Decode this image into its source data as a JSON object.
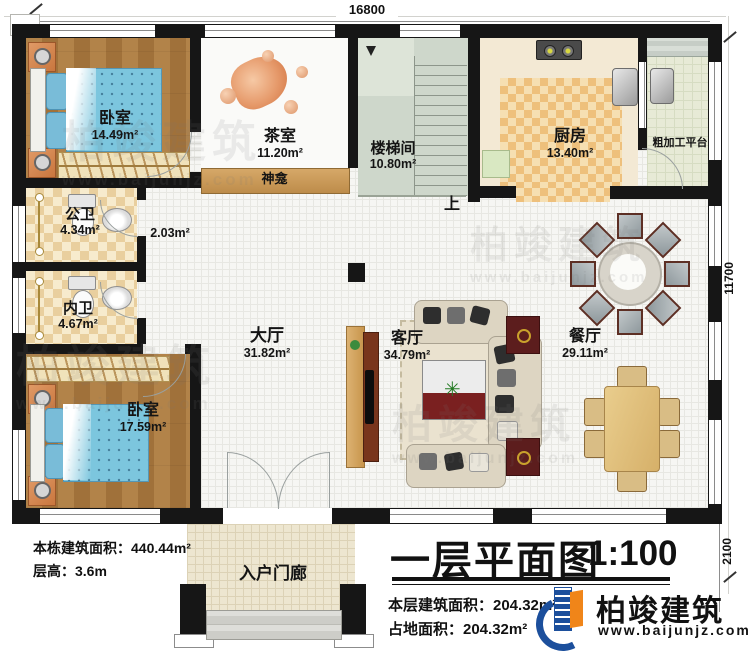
{
  "dimensions": {
    "width_total": "16800",
    "depth_total": "11700",
    "porch_depth": "2100"
  },
  "rooms": {
    "bedroom1": {
      "name": "卧室",
      "area": "14.49m²"
    },
    "tea_room": {
      "name": "茶室",
      "area": "11.20m²"
    },
    "stairwell": {
      "name": "楼梯间",
      "area": "10.80m²"
    },
    "kitchen": {
      "name": "厨房",
      "area": "13.40m²"
    },
    "prep_platform": {
      "name": "粗加工平台"
    },
    "shrine": {
      "name": "神龛"
    },
    "public_bath": {
      "name": "公卫",
      "area": "4.34m²"
    },
    "corridor": {
      "area": "2.03m²"
    },
    "inner_bath": {
      "name": "内卫",
      "area": "4.67m²"
    },
    "bedroom2": {
      "name": "卧室",
      "area": "17.59m²"
    },
    "hall": {
      "name": "大厅",
      "area": "31.82m²"
    },
    "living_room": {
      "name": "客厅",
      "area": "34.79m²"
    },
    "dining_room": {
      "name": "餐厅",
      "area": "29.11m²"
    },
    "entry_porch": {
      "name": "入户门廊"
    },
    "stairs_up_label": "上"
  },
  "footer_left": {
    "total_building_area": "本栋建筑面积：440.44m²",
    "floor_height": "层高：3.6m"
  },
  "title_block": {
    "title": "一层平面图",
    "scale": "1:100",
    "floor_area": "本层建筑面积：204.32m²",
    "footprint_area": "占地面积：204.32m²"
  },
  "brand": {
    "name": "柏竣建筑",
    "website": "www.baijunjz.com"
  },
  "watermark": {
    "name": "柏竣建筑",
    "website": "www.baijunjz.com"
  },
  "colors": {
    "wall": "#161616",
    "wood_floor": "#a97a3f",
    "bath_tile": "#e9cf9e",
    "kitchen_rug": "#eec07c",
    "bed_blue": "#7cc6de",
    "shrine_wood": "#c9995a",
    "stair_floor": "#ced7cb",
    "logo_blue": "#1c4f9c",
    "logo_orange": "#f08519"
  }
}
